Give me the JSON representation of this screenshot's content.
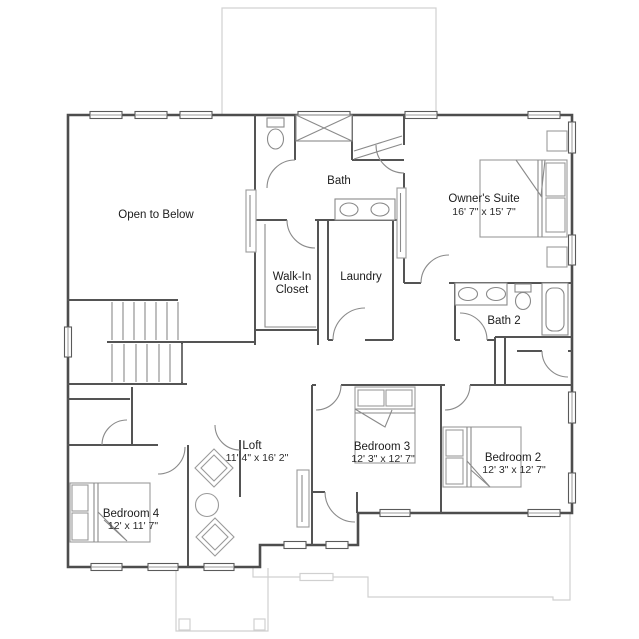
{
  "plan": {
    "rooms": {
      "open_to_below": {
        "name": "Open to Below"
      },
      "bath": {
        "name": "Bath"
      },
      "owners_suite": {
        "name": "Owner's Suite",
        "dimensions": "16' 7\" x 15' 7\""
      },
      "walk_in_closet": {
        "name_line1": "Walk-In",
        "name_line2": "Closet"
      },
      "laundry": {
        "name": "Laundry"
      },
      "bath_2": {
        "name": "Bath 2"
      },
      "loft": {
        "name": "Loft",
        "dimensions": "11' 4\" x 16' 2\""
      },
      "bedroom_3": {
        "name": "Bedroom 3",
        "dimensions": "12' 3\" x 12' 7\""
      },
      "bedroom_2": {
        "name": "Bedroom 2",
        "dimensions": "12' 3\" x 12' 7\""
      },
      "bedroom_4": {
        "name": "Bedroom 4",
        "dimensions": "12' x 11' 7\""
      }
    },
    "colors": {
      "exterior_wall": "#4d4d4d",
      "interior_wall": "#545454",
      "thin_line": "#8a8a8a",
      "roof_outline": "#d0d0d0",
      "text": "#1c1c1c",
      "background": "#ffffff"
    }
  }
}
